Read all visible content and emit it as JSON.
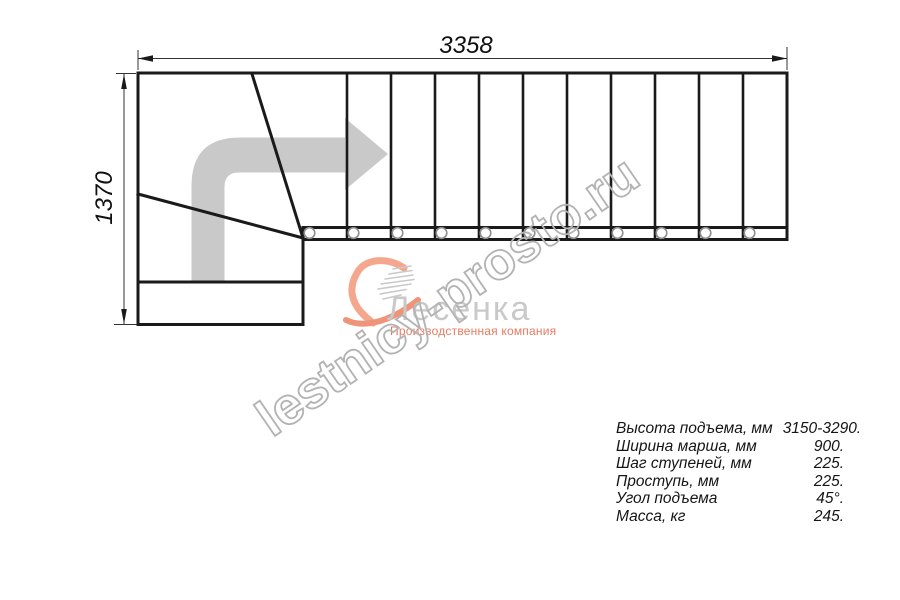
{
  "drawing": {
    "top_dimension": "3358",
    "left_dimension": "1370",
    "direction_arrow_icon": "direction-arrow-icon"
  },
  "watermark": {
    "text": "lestnicy-prosto.ru",
    "color": "#b3b3b3"
  },
  "logo": {
    "mark_icon": "heart-swoosh-icon",
    "name": "Лесенка",
    "tagline": "Производственная компания",
    "name_color": "#c9c9c9",
    "accent_color": "#f2a086",
    "tagline_color": "#e87a61"
  },
  "specs": {
    "rows": [
      {
        "label": "Высота подъема, мм",
        "value": "3150-3290."
      },
      {
        "label": "Ширина марша, мм",
        "value": "900."
      },
      {
        "label": "Шаг ступеней, мм",
        "value": "225."
      },
      {
        "label": "Проступь, мм",
        "value": "225."
      },
      {
        "label": "Угол подъема",
        "value": "45°."
      },
      {
        "label": "Масса, кг",
        "value": "245."
      }
    ]
  },
  "colors": {
    "line": "#1a1a1a",
    "dimension_line": "#333333",
    "arrow_gray": "#c9c9c9",
    "circle_gray": "#8f8f8f"
  }
}
